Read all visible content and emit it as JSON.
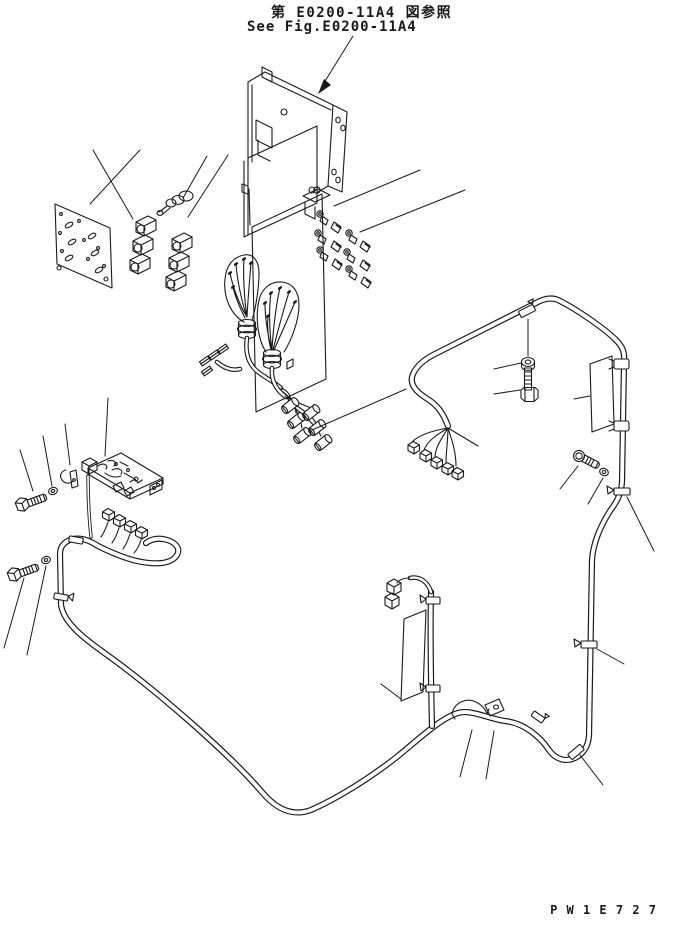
{
  "page": {
    "background": "#ffffff",
    "line_color": "#1a1a1a"
  },
  "header": {
    "reference_jp": "第 E0200-11A4 図参照",
    "reference_en": "See Fig.E0200-11A4"
  },
  "footer": {
    "drawing_code": "P W 1 E 7 2 7"
  }
}
